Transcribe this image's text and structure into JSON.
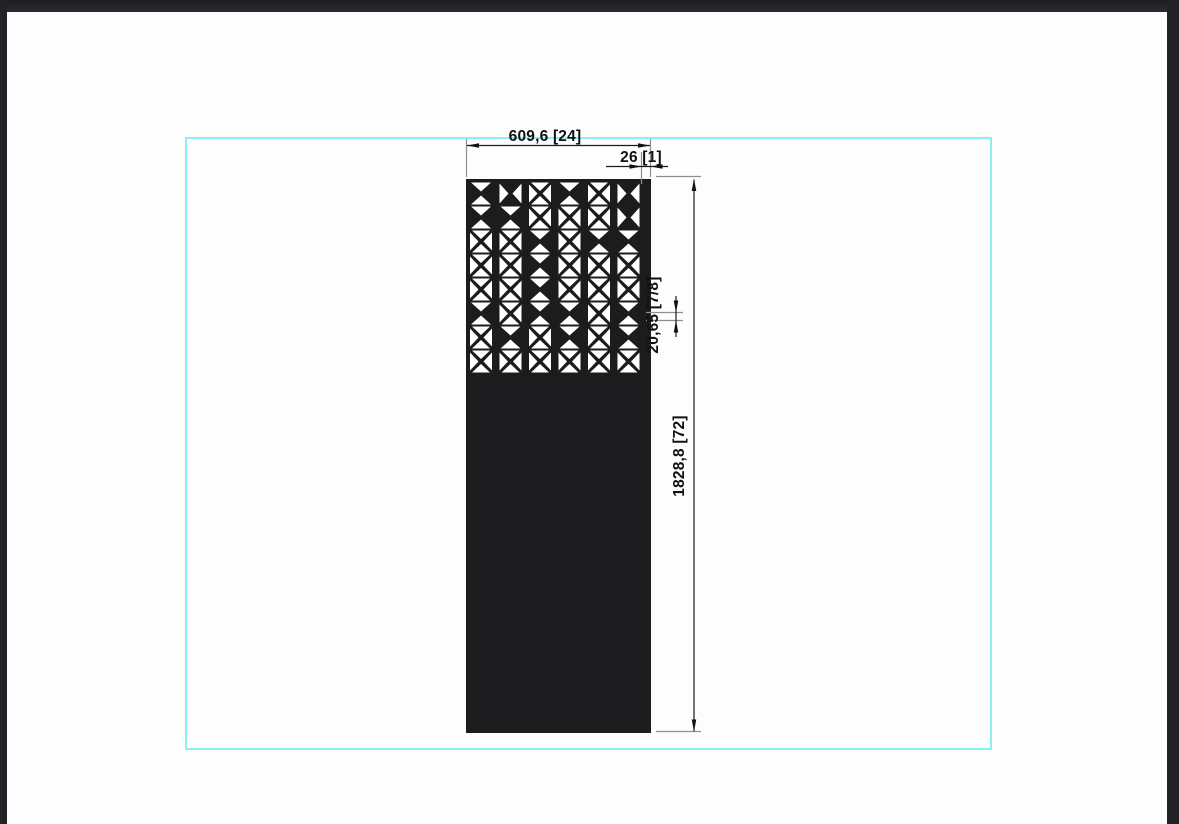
{
  "window": {
    "frame_color": "#232327",
    "canvas_color": "#fdfdfd"
  },
  "sheet": {
    "border_color": "#8BF0F4"
  },
  "drawing": {
    "dimensions": {
      "width_label": "609,6 [24]",
      "margin_label": "26 [1]",
      "pitch_label": "20,65 [7/8]",
      "height_label": "1828,8 [72]"
    },
    "panel": {
      "fill": "#1C1C1E",
      "cutout_color": "#ffffff",
      "pattern_rows": [
        [
          "v",
          "h",
          "x",
          "v",
          "x",
          "h"
        ],
        [
          "v",
          "v",
          "x",
          "x",
          "x",
          "h"
        ],
        [
          "x",
          "x",
          "v",
          "x",
          "v",
          "v"
        ],
        [
          "x",
          "x",
          "v",
          "x",
          "x",
          "x"
        ],
        [
          "x",
          "x",
          "v",
          "x",
          "x",
          "x"
        ],
        [
          "v",
          "x",
          "v",
          "v",
          "x",
          "v"
        ],
        [
          "x",
          "v",
          "x",
          "v",
          "x",
          "v"
        ],
        [
          "x",
          "x",
          "x",
          "x",
          "x",
          "x"
        ]
      ]
    }
  }
}
